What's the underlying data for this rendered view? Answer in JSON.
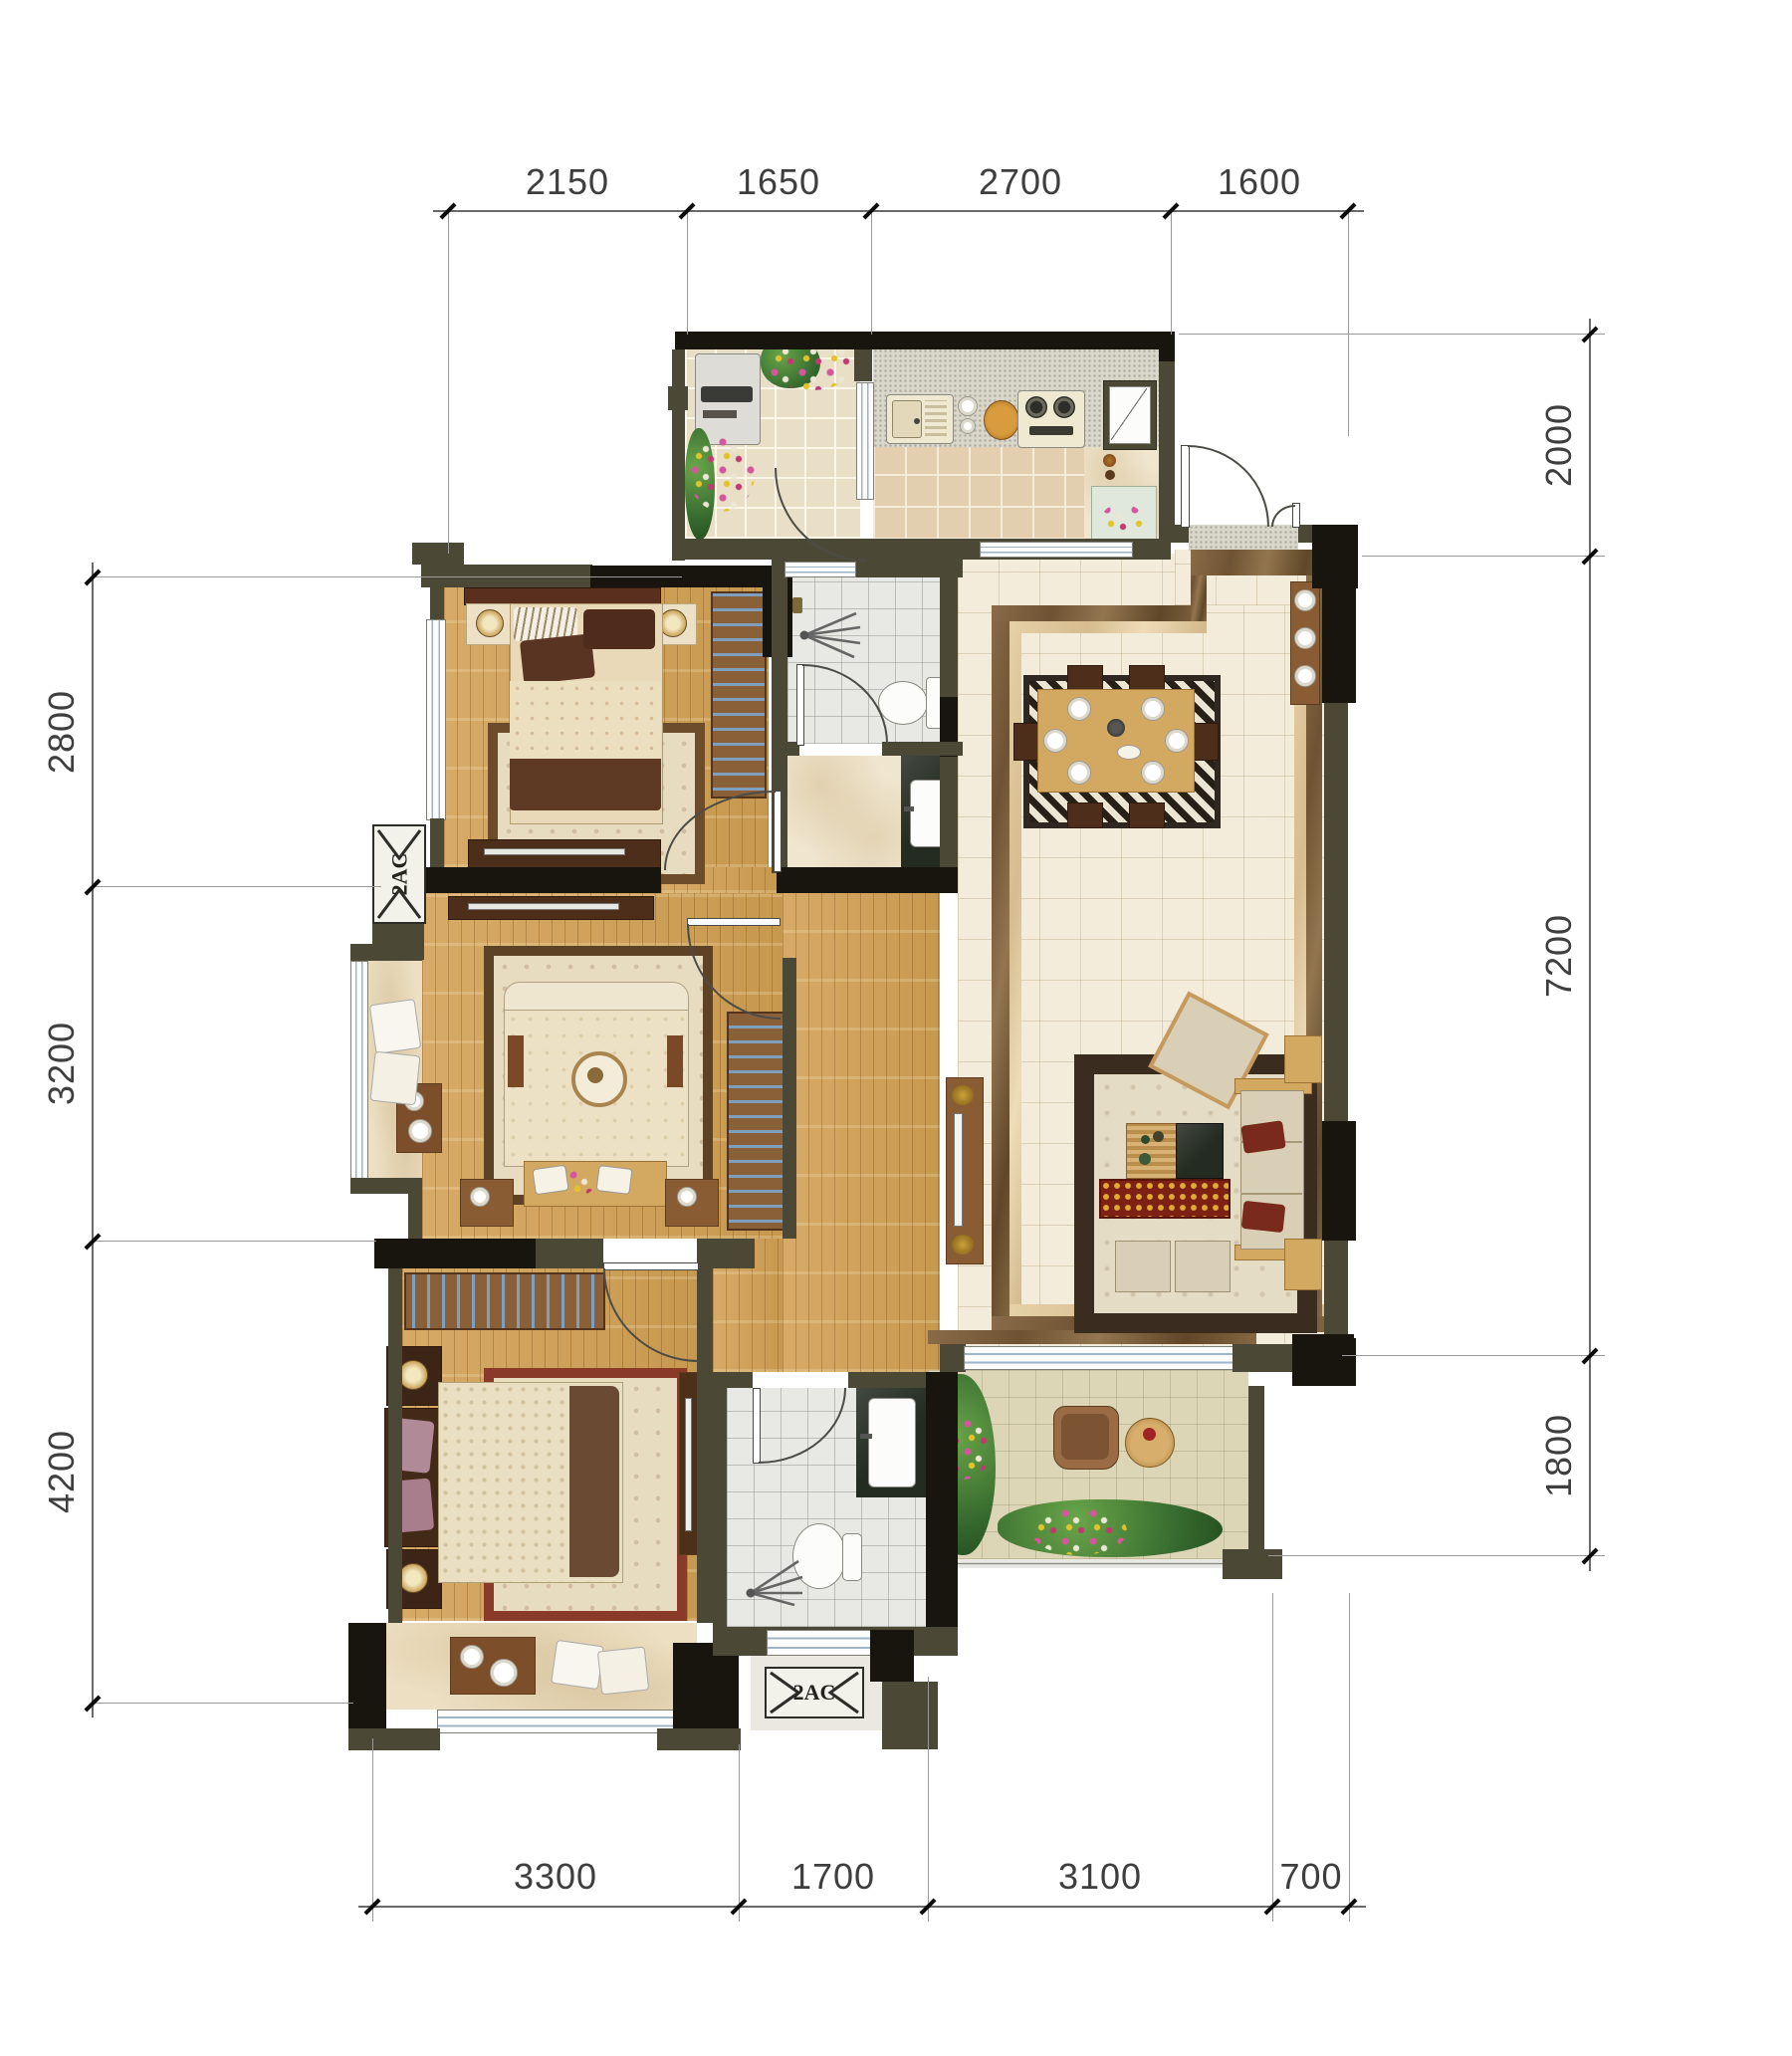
{
  "title": "apartment-floor-plan",
  "dimensions": {
    "top": [
      "2150",
      "1650",
      "2700",
      "1600"
    ],
    "left": [
      "2800",
      "3200",
      "4200"
    ],
    "right": [
      "2000",
      "7200",
      "1800"
    ],
    "bottom": [
      "3300",
      "1700",
      "3100",
      "700"
    ]
  },
  "labels": {
    "ac_left": "2AC",
    "ac_bottom": "2AC"
  },
  "icons": {
    "toilet": "toilet-icon",
    "shower": "shower-spray-icon",
    "sink": "sink-icon",
    "stove": "gas-stove-icon",
    "washer": "washing-machine-icon",
    "door_swing": "door-swing-arc"
  },
  "colors": {
    "wall_olive": "#4b4936",
    "wall_black": "#17150e",
    "wood_floor": "#d0a15c",
    "living_floor": "#f3ecdb",
    "marble_border": "#8a6b47",
    "kitchen_tile": "#e4ceb0",
    "bath_tile": "#e8e8e5",
    "balcony_tile": "#dcd5b6",
    "counter_dark": "#242b21",
    "plant_green": "#31682a",
    "flower_pink": "#d4569c",
    "rug_border": "#3a2d1f",
    "dim_text": "#3e3e3e"
  }
}
